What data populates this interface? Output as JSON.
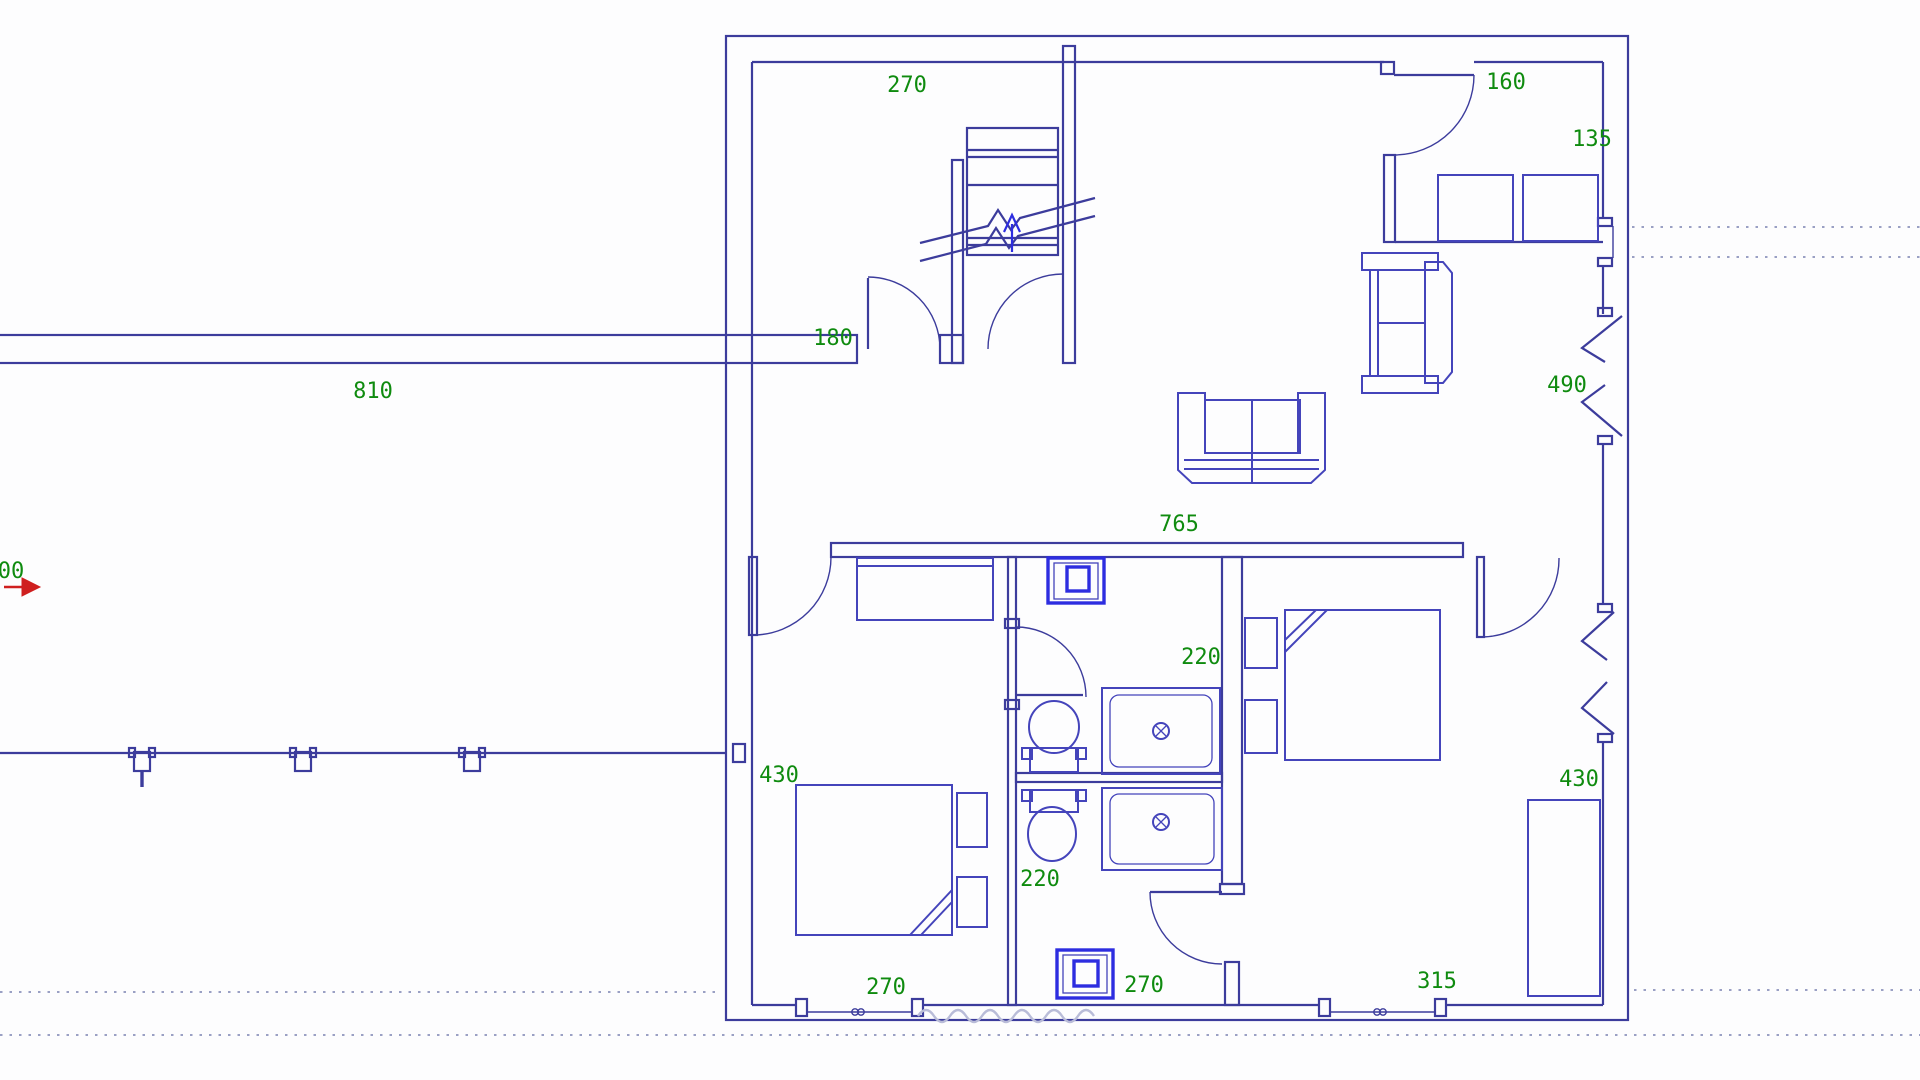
{
  "drawing": {
    "type": "architectural-floor-plan",
    "description": "CAD floor plan of an apartment with living room, kitchen, two bedrooms, two bathrooms, staircase and terrace",
    "background": "#fdfdfe"
  },
  "colors": {
    "wall_line": "#3c3c9c",
    "furniture_line": "#4444bb",
    "fixture_line": "#2d2de0",
    "dimension_text": "#0f8b0f",
    "marker_red": "#cf1f1f",
    "reference_dotted": "#9aa0c4",
    "watermark": "#b9bcd8"
  },
  "labels": {
    "top_room": "270",
    "kitchen_door": "160",
    "kitchen_right": "135",
    "hall_door": "180",
    "terrace": "810",
    "window_right": "490",
    "living_width": "765",
    "bath_upper": "220",
    "bedroom_left": "430",
    "bath_lower": "220",
    "bedroom_right": "430",
    "opening_left": "270",
    "opening_center": "270",
    "opening_right": "315",
    "edge_partial": "00"
  }
}
